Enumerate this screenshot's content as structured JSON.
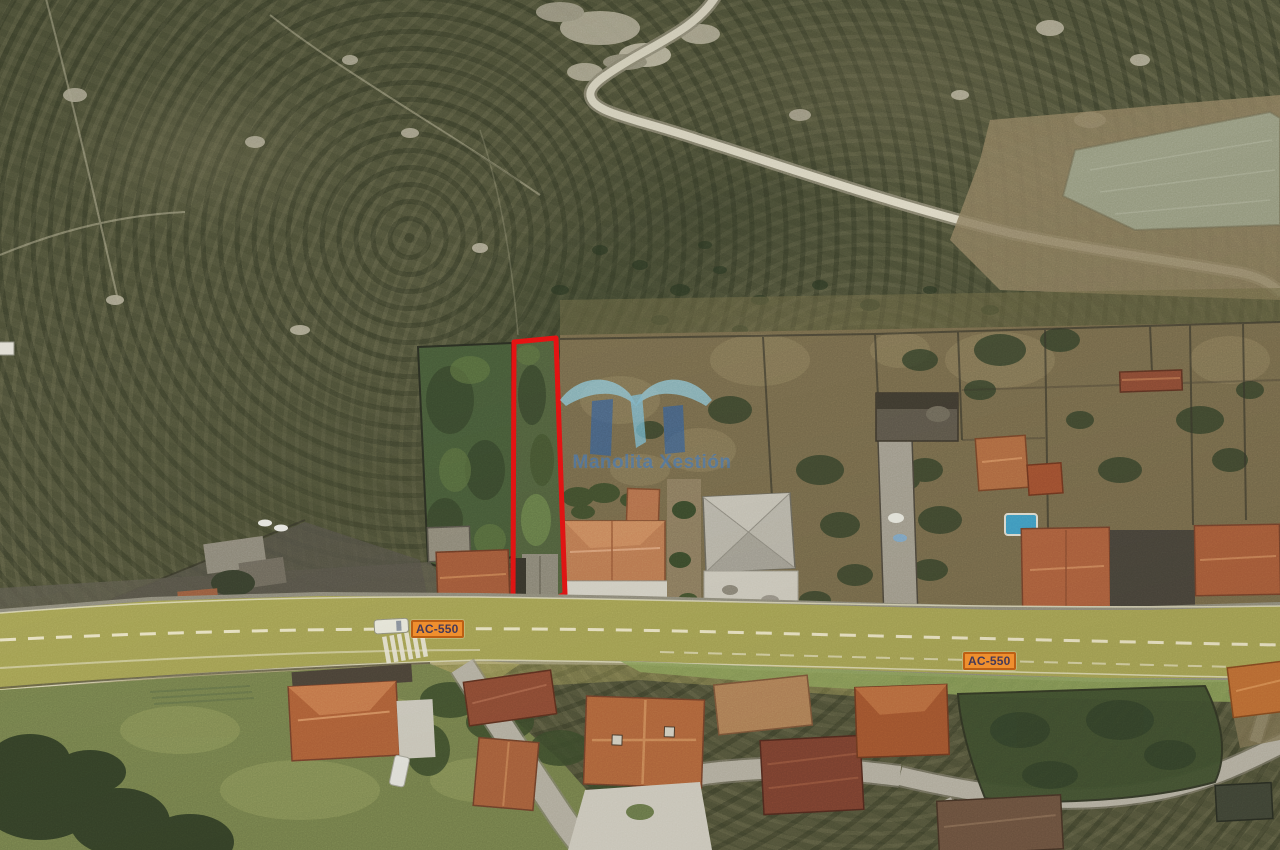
{
  "scene": {
    "type": "satellite-aerial-photo",
    "subject": "rural hillside village with a narrow plot outlined in red beside road AC-550",
    "parcel_outline_color": "#e51212",
    "road_highlight_color": "#a9a54f"
  },
  "road_labels": [
    {
      "text": "AC-550"
    },
    {
      "text": "AC-550"
    }
  ],
  "watermark": {
    "brand": "Manolita Xestión",
    "logo_light_blue": "#8fd0e8",
    "logo_dark_blue": "#2e5fa0",
    "text_color": "#3a76bc"
  },
  "badge_style": {
    "background": "#ef8f2e",
    "border": "#bc5f14",
    "text_color": "#453a58"
  }
}
